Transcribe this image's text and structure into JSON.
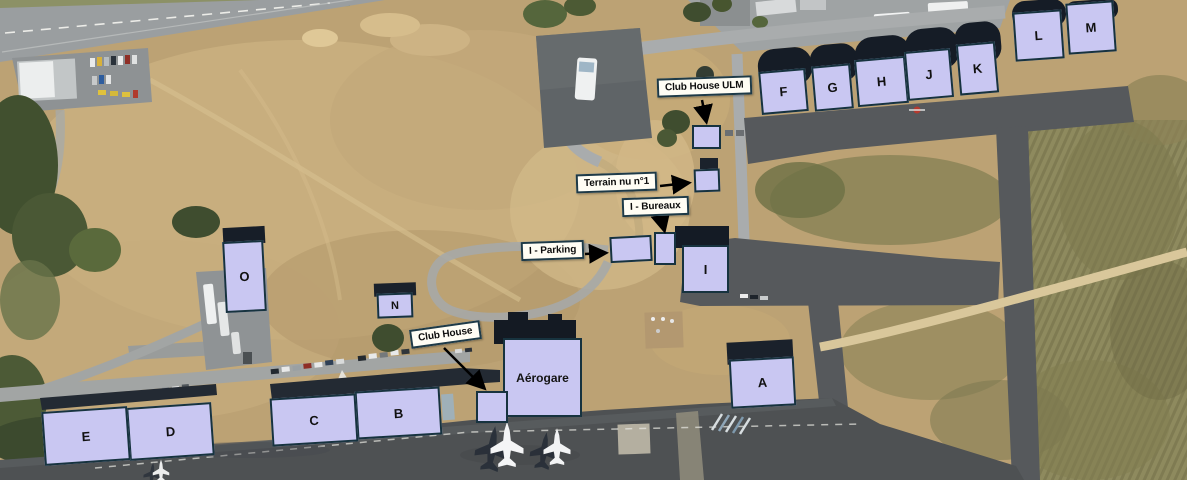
{
  "buildings": [
    {
      "id": "a",
      "label": "A"
    },
    {
      "id": "b",
      "label": "B"
    },
    {
      "id": "c",
      "label": "C"
    },
    {
      "id": "d",
      "label": "D"
    },
    {
      "id": "e",
      "label": "E"
    },
    {
      "id": "f",
      "label": "F"
    },
    {
      "id": "g",
      "label": "G"
    },
    {
      "id": "h",
      "label": "H"
    },
    {
      "id": "i",
      "label": "I"
    },
    {
      "id": "j",
      "label": "J"
    },
    {
      "id": "k",
      "label": "K"
    },
    {
      "id": "l",
      "label": "L"
    },
    {
      "id": "m",
      "label": "M"
    },
    {
      "id": "n",
      "label": "N"
    },
    {
      "id": "o",
      "label": "O"
    }
  ],
  "terminal": {
    "label": "Aérogare"
  },
  "callouts": {
    "club_house_ulm": "Club House ULM",
    "terrain_nu_1": "Terrain nu n°1",
    "i_bureaux": "I - Bureaux",
    "i_parking": "I - Parking",
    "club_house": "Club House"
  },
  "colors": {
    "building_fill": "#c9c7f2",
    "building_border": "#17333f",
    "label_bg": "#fffdf4",
    "label_border": "#1e3a47",
    "arrow_color": "#000000"
  }
}
